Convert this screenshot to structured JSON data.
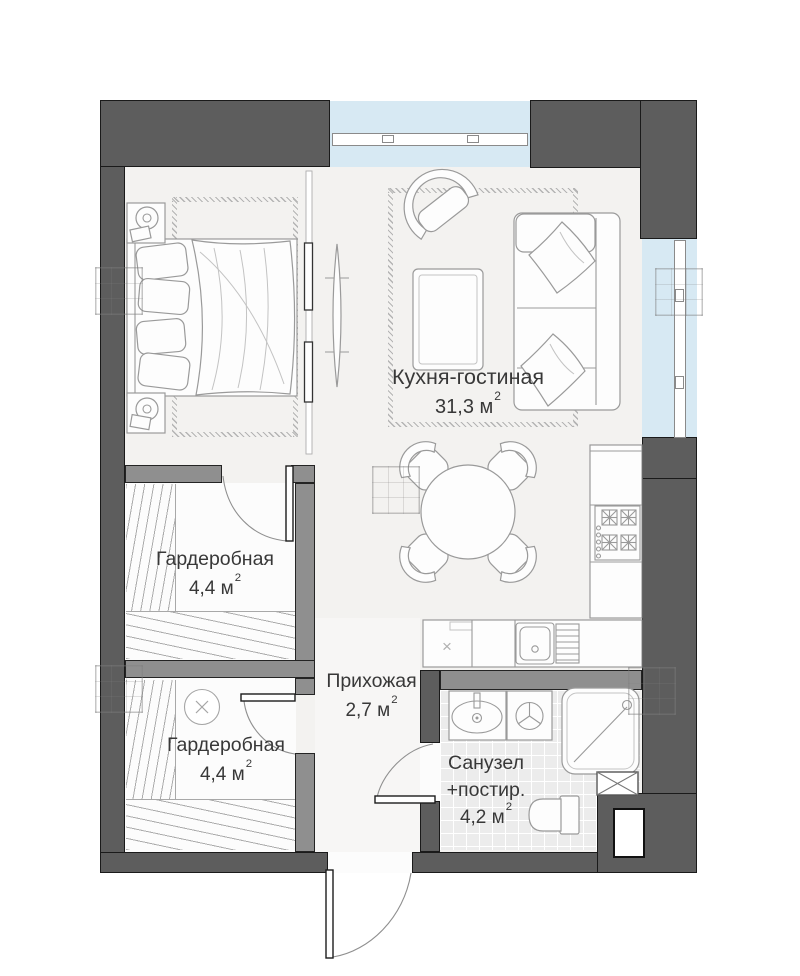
{
  "rooms": {
    "kitchen_living": {
      "name": "Кухня-гостиная",
      "area": "31,3 м",
      "area_sup": "2"
    },
    "wardrobe_top": {
      "name": "Гардеробная",
      "area": "4,4 м",
      "area_sup": "2"
    },
    "wardrobe_bottom": {
      "name": "Гардеробная",
      "area": "4,4 м",
      "area_sup": "2"
    },
    "hallway": {
      "name": "Прихожая",
      "area": "2,7 м",
      "area_sup": "2"
    },
    "bathroom": {
      "name": "Санузел",
      "name_line2": "+постир.",
      "area": "4,2 м",
      "area_sup": "2"
    }
  },
  "symbols": {
    "appliance_mark": "×"
  },
  "colors": {
    "wall_outer": "#5d5d5d",
    "wall_inner": "#8f8f8f",
    "window_glass": "#d7e9f3",
    "floor_main": "#f3f2f0",
    "floor_tile": "#ececec",
    "outline": "#1a1a1a",
    "furn": "#9a9a9a",
    "label": "#383838"
  }
}
